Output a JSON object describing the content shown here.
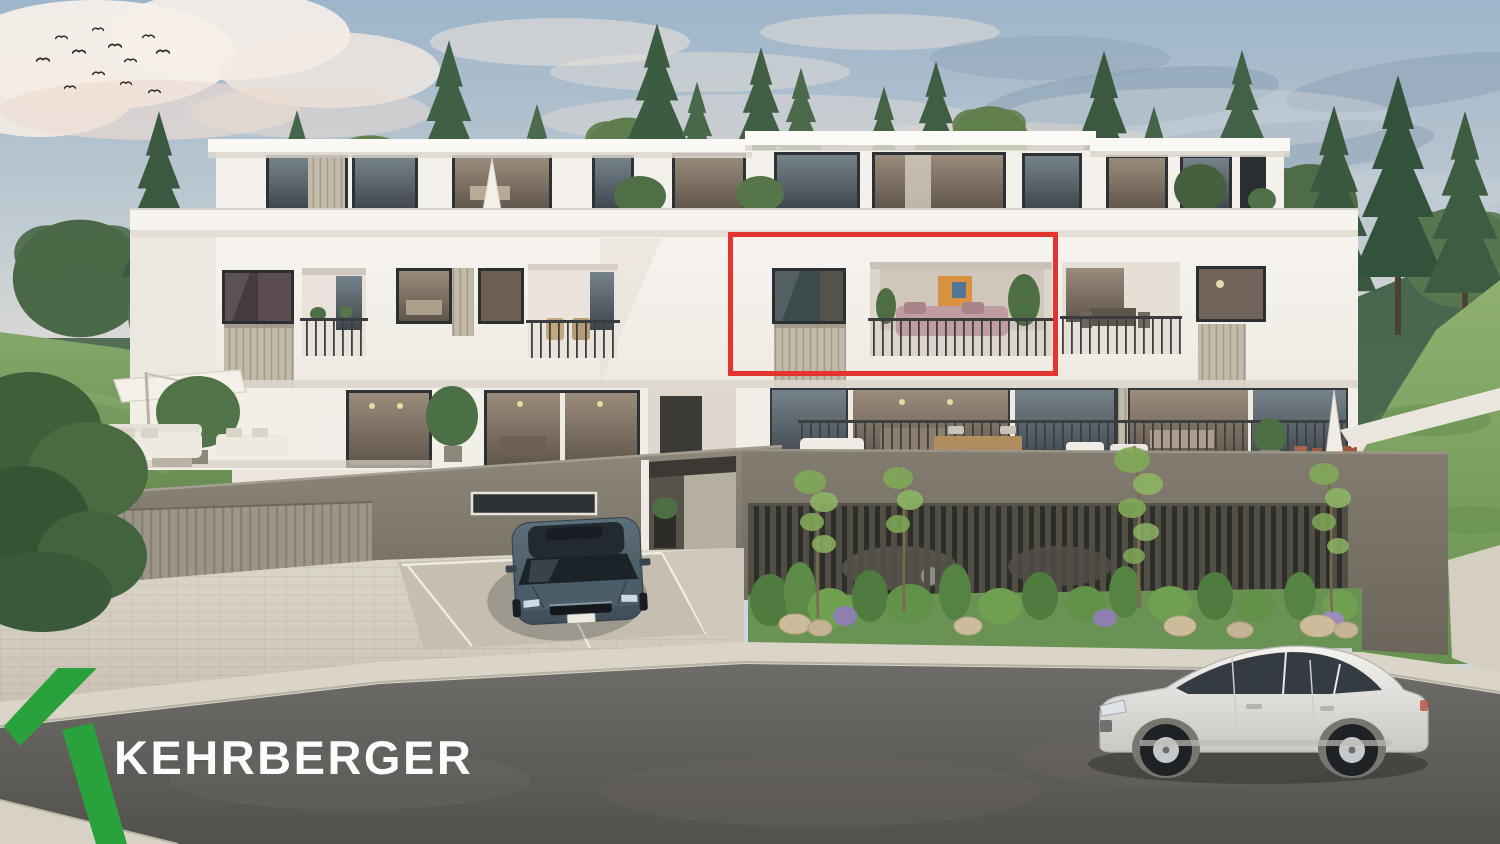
{
  "branding": {
    "name": "KEHRBERGER",
    "mark_color": "#2aa23c",
    "text_color": "#fcfcfc"
  },
  "annotation": {
    "purpose": "highlighted-apartment-unit",
    "border_color": "#e33430"
  },
  "scene": {
    "type": "architectural-exterior-rendering",
    "description": "Modern white three-level apartment building with roof terraces, recessed balconies, wood-slat privacy screens, a grey garage podium with slatted fence and planting bed, street in front; a red rectangle marks one upper-floor apartment; KEHRBERGER logo overlay at bottom left.",
    "environment": [
      "sky with soft clouds",
      "flock of birds",
      "conifer and broadleaf trees",
      "grass hills"
    ],
    "vehicles": [
      {
        "name": "parked-sedan",
        "color": "#4d6270"
      },
      {
        "name": "street-suv",
        "color": "#eceae6"
      }
    ]
  },
  "palette": {
    "sky_top": "#9db5ca",
    "sky_horizon": "#ece6de",
    "facade_white": "#f6f3ee",
    "podium_grey": "#847d72",
    "wood_slat": "#c3baa9",
    "tree_green": "#45624a",
    "grass_green": "#6f9457",
    "road_asphalt": "#5f5d5a",
    "sidewalk": "#d9d3c7",
    "highlight_red": "#e33430",
    "logo_green": "#2aa23c"
  }
}
